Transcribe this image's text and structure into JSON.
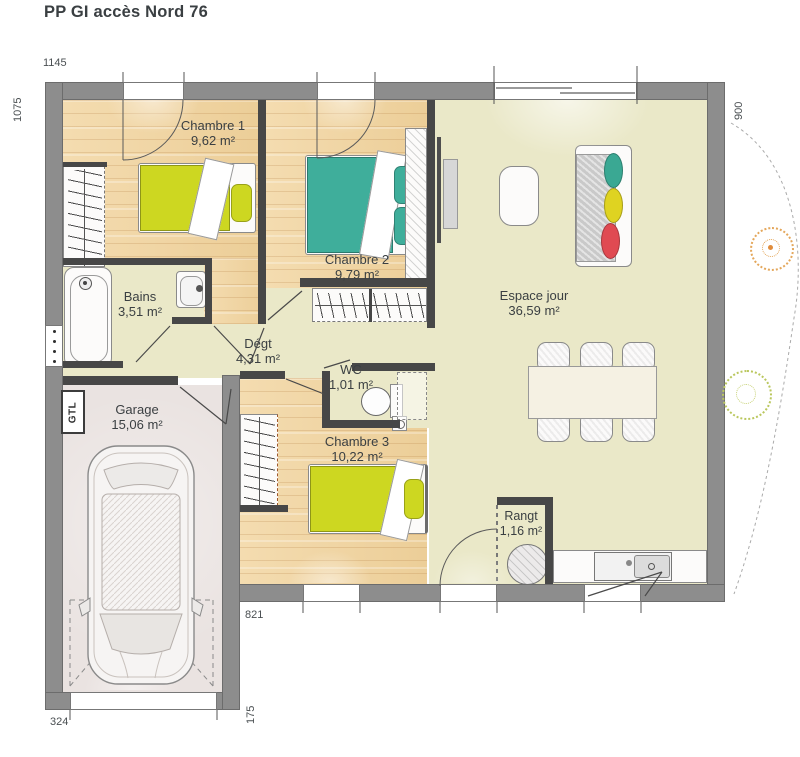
{
  "title": "PP GI accès Nord 76",
  "rooms": {
    "chambre1": {
      "name": "Chambre 1",
      "area": "9,62 m²"
    },
    "chambre2": {
      "name": "Chambre 2",
      "area": "9,79 m²"
    },
    "chambre3": {
      "name": "Chambre 3",
      "area": "10,22 m²"
    },
    "bains": {
      "name": "Bains",
      "area": "3,51 m²"
    },
    "degagement": {
      "name": "Dégt",
      "area": "4,31 m²"
    },
    "wc": {
      "name": "WC",
      "area": "1,01 m²"
    },
    "espace_jour": {
      "name": "Espace jour",
      "area": "36,59 m²"
    },
    "rangement": {
      "name": "Rangt",
      "area": "1,16 m²"
    },
    "garage": {
      "name": "Garage",
      "area": "15,06 m²"
    }
  },
  "dimensions": {
    "top": "1145",
    "left": "1075",
    "right": "900",
    "bottom": "821",
    "garage_height": "175",
    "garage_width": "324"
  },
  "labels": {
    "gtl": "GTL"
  },
  "colors": {
    "exterior_wall": "#8d8d8d",
    "partition_wall": "#474747",
    "wood_floor": "#f2d7a8",
    "living_floor": "#eae8c8",
    "garage_floor": "#eae3e1",
    "bed_yellow": "#cdd721",
    "bed_teal": "#3fae9b",
    "cushion_teal": "#3aa893",
    "cushion_yellow": "#dfd321",
    "cushion_red": "#e04a52"
  }
}
